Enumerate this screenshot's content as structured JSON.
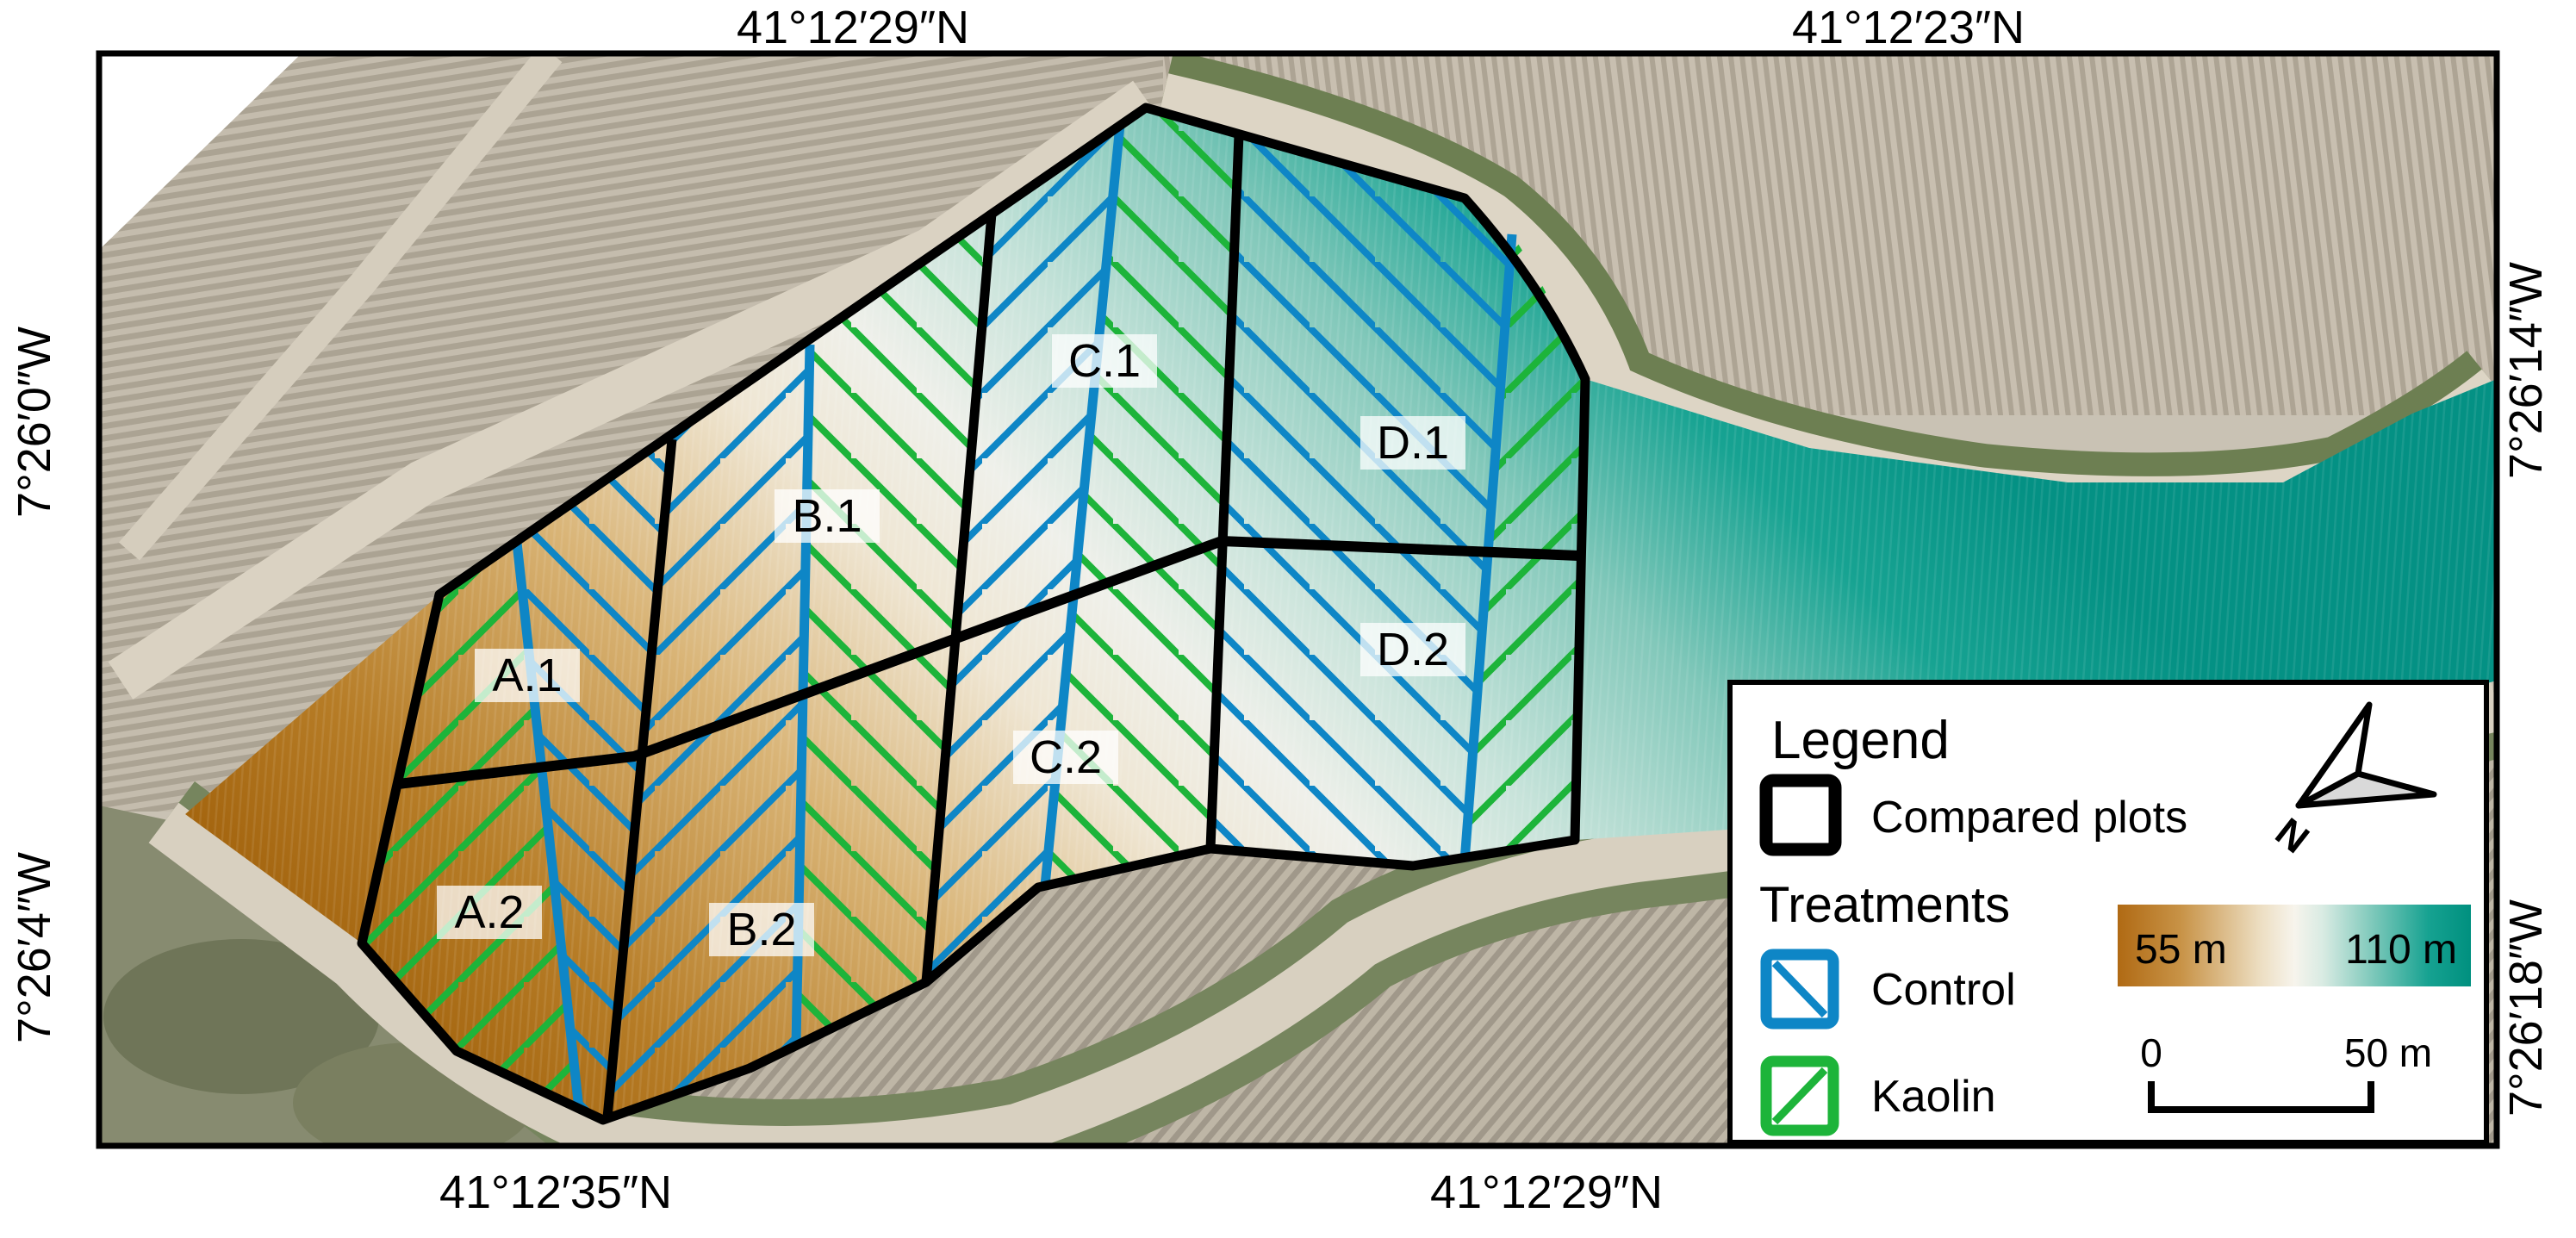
{
  "coordinates": {
    "top_left": "41°12′29″N",
    "top_right": "41°12′23″N",
    "bottom_left": "41°12′35″N",
    "bottom_right": "41°12′29″N",
    "left_upper": "7°26′0″W",
    "left_lower": "7°26′4″W",
    "right_upper": "7°26′14″W",
    "right_lower": "7°26′18″W"
  },
  "plots": {
    "a1": "A.1",
    "a2": "A.2",
    "b1": "B.1",
    "b2": "B.2",
    "c1": "C.1",
    "c2": "C.2",
    "d1": "D.1",
    "d2": "D.2"
  },
  "legend": {
    "title": "Legend",
    "compared_plots_label": "Compared plots",
    "treatments_label": "Treatments",
    "control_label": "Control",
    "kaolin_label": "Kaolin",
    "north_label": "N"
  },
  "elevation_ramp": {
    "min_label": "55 m",
    "max_label": "110 m",
    "low_color": "#b06a14",
    "high_color": "#00907f"
  },
  "scale_bar": {
    "zero_label": "0",
    "length_label": "50 m"
  },
  "colors": {
    "control_blue": "#0e86c6",
    "kaolin_green": "#1db43a",
    "plot_outline": "#000000"
  }
}
